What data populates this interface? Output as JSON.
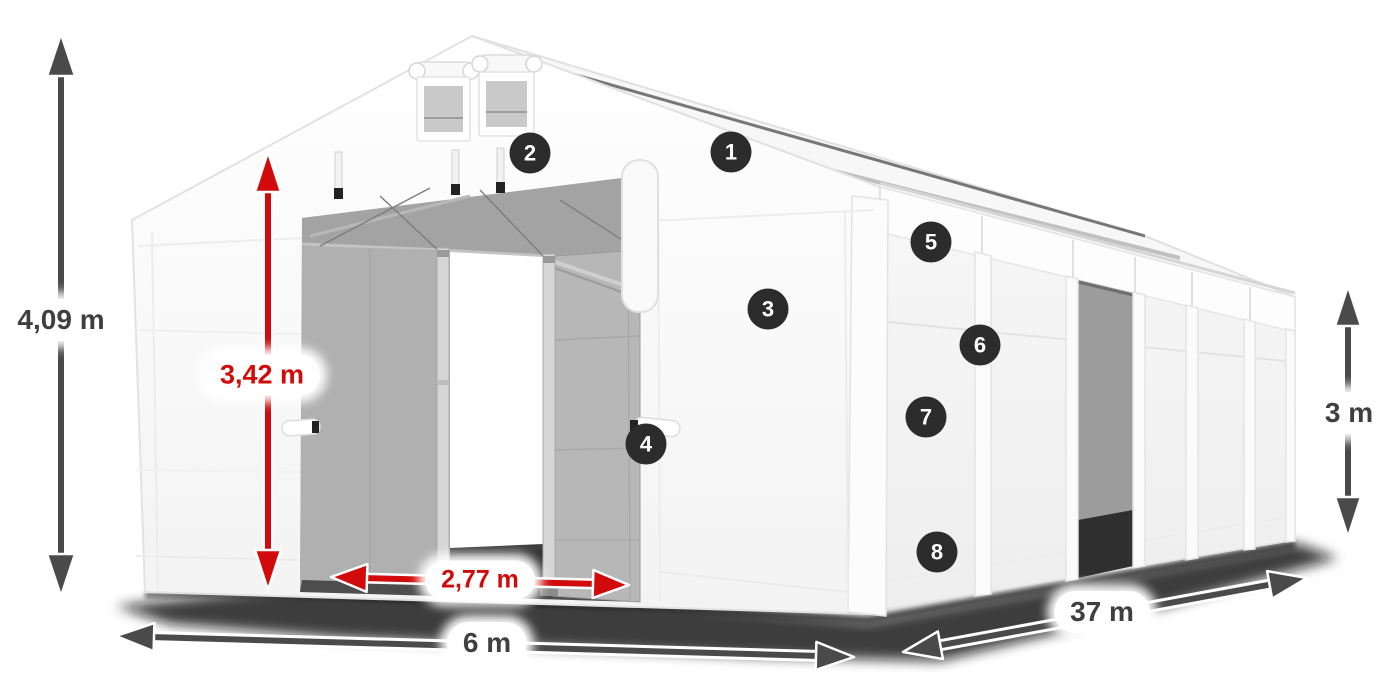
{
  "figure": {
    "description": "White storage tent hangar 3D product illustration with dimension arrows and numbered part markers",
    "background": "#ffffff"
  },
  "dimension_labels": {
    "total_height": "4,09 m",
    "door_clear_height": "3,42 m",
    "door_width": "2,77 m",
    "tent_width": "6 m",
    "tent_length": "37 m",
    "side_wall_height": "3 m"
  },
  "callout_markers": [
    "1",
    "2",
    "3",
    "4",
    "5",
    "6",
    "7",
    "8"
  ],
  "colors": {
    "dimension_arrow_gray": "#4a4a4a",
    "dimension_arrow_red": "#d10b0b",
    "label_pill_bg": "#ffffff",
    "label_text_gray": "#3f3f3f",
    "label_text_red": "#d10b0b",
    "marker_bg": "#2c2c2c",
    "marker_text": "#ffffff",
    "tent_white": "#fbfbfb",
    "interior_gray": "#b3b3b3",
    "shadow_black": "#111111"
  }
}
